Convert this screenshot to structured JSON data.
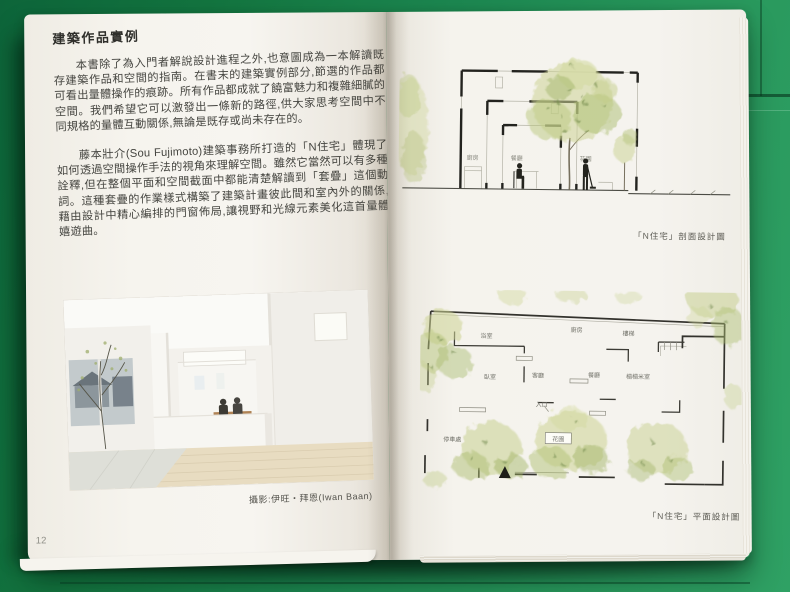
{
  "left_page": {
    "title": "建築作品實例",
    "paragraphs": [
      "本書除了為入門者解說設計進程之外,也意圖成為一本解讀既存建築作品和空間的指南。在書末的建築實例部分,節選的作品都可看出量體操作的痕跡。所有作品都成就了饒富魅力和複雜細膩的空間。我們希望它可以激發出一條新的路徑,供大家思考空間中不同規格的量體互動關係,無論是既存或尚未存在的。",
      "藤本壯介(Sou Fujimoto)建築事務所打造的「N住宅」體現了如何透過空間操作手法的視角來理解空間。雖然它當然可以有多種詮釋,但在整個平面和空間截面中都能清楚解讀到「套疊」這個動詞。這種套疊的作業樣式構築了建築計畫彼此間和室內外的關係,藉由設計中精心編排的門窗佈局,讓視野和光線元素美化這首量體嬉遊曲。"
    ],
    "photo_caption": "攝影:伊旺・拜恩(Iwan Baan)",
    "page_number": "12"
  },
  "right_page": {
    "section": {
      "caption": "「N住宅」剖面設計圖",
      "labels": {
        "kitchen": "廚房",
        "dining": "餐廳",
        "garden": "花園"
      }
    },
    "plan": {
      "caption": "「N住宅」平面設計圖",
      "labels": {
        "bath": "浴室",
        "kitchen": "廚房",
        "stairs": "樓梯",
        "bedroom": "臥室",
        "living": "客廳",
        "dining": "餐廳",
        "tatami": "榻榻米室",
        "entrance": "入口",
        "parking": "停車處",
        "garden": "花園"
      }
    }
  },
  "colors": {
    "mat_green": "#1c8750",
    "mat_green_light": "#2fa164",
    "mat_green_dark": "#0d653a",
    "paper": "#f5f3ed",
    "tree_green": "#b9c77e",
    "ink": "#2f2f2b"
  }
}
